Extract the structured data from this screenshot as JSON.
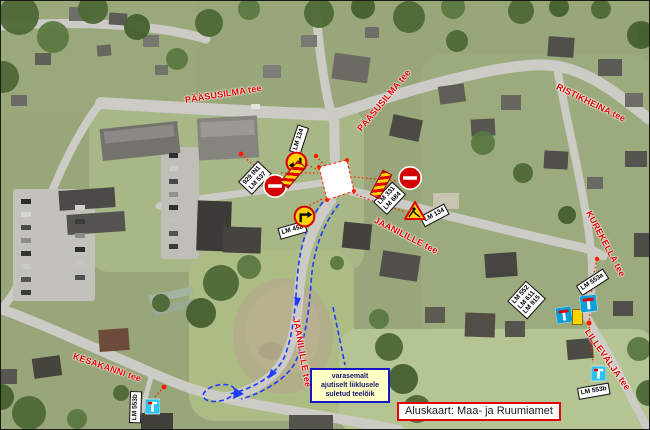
{
  "basemap": {
    "credit": "Aluskaart: Maa- ja Ruumiamet"
  },
  "note": {
    "line1": "varasemalt",
    "line2": "ajutiselt liiklusele",
    "line3": "suletud teelõik"
  },
  "streets": [
    {
      "name": "PÄÄSUSILMA tee"
    },
    {
      "name": "PÄÄSUSILMA tee"
    },
    {
      "name": "RISTIKHEINA tee"
    },
    {
      "name": "KUREKELLA tee"
    },
    {
      "name": "JAANILILLE tee"
    },
    {
      "name": "JAANILILLE tee"
    },
    {
      "name": "KESAKANNI tee"
    },
    {
      "name": "LILLEVÄLJA tee"
    }
  ],
  "sign_labels": {
    "lm134_north": "LM 134",
    "left_pair_line1": "929 IN1",
    "left_pair_line2": "LM 537",
    "right_pair_line1": "LM 331",
    "right_pair_line2": "LM 684",
    "lm452": "LM 452",
    "lm134_east": "LM 134",
    "cluster_line1": "LM 552",
    "cluster_line2": "LM 611",
    "cluster_line3": "LM 915",
    "lm553a": "LM 553a",
    "lm553b_east": "LM 553b",
    "lm553b_west": "LM 553b"
  },
  "icons": {
    "no_entry_sign": "red-circle-white-bar",
    "detour_arrow_sign": "yellow-circle-black-arrow",
    "roadworks_sign": "yellow-triangle-red-border",
    "dead_end_sign": "blue-square-white-tee-red-bar",
    "barrier": "red-yellow-diagonal-stripes",
    "closed_area": "white-polygon-red-dashed",
    "detour_route": "blue-dashed-line"
  },
  "colors": {
    "street_label": "#e60000",
    "sign_label_bg": "#ffffff",
    "note_bg": "#ffffc6",
    "note_border": "#1616c8",
    "note_text": "#14146e",
    "credit_border": "#e60000",
    "route_blue": "#1e3cff",
    "connector_red": "#ff1e00",
    "no_entry_red": "#d40000",
    "temp_sign_yellow": "#ffd300",
    "dead_end_blue": "#0a9fdc"
  }
}
